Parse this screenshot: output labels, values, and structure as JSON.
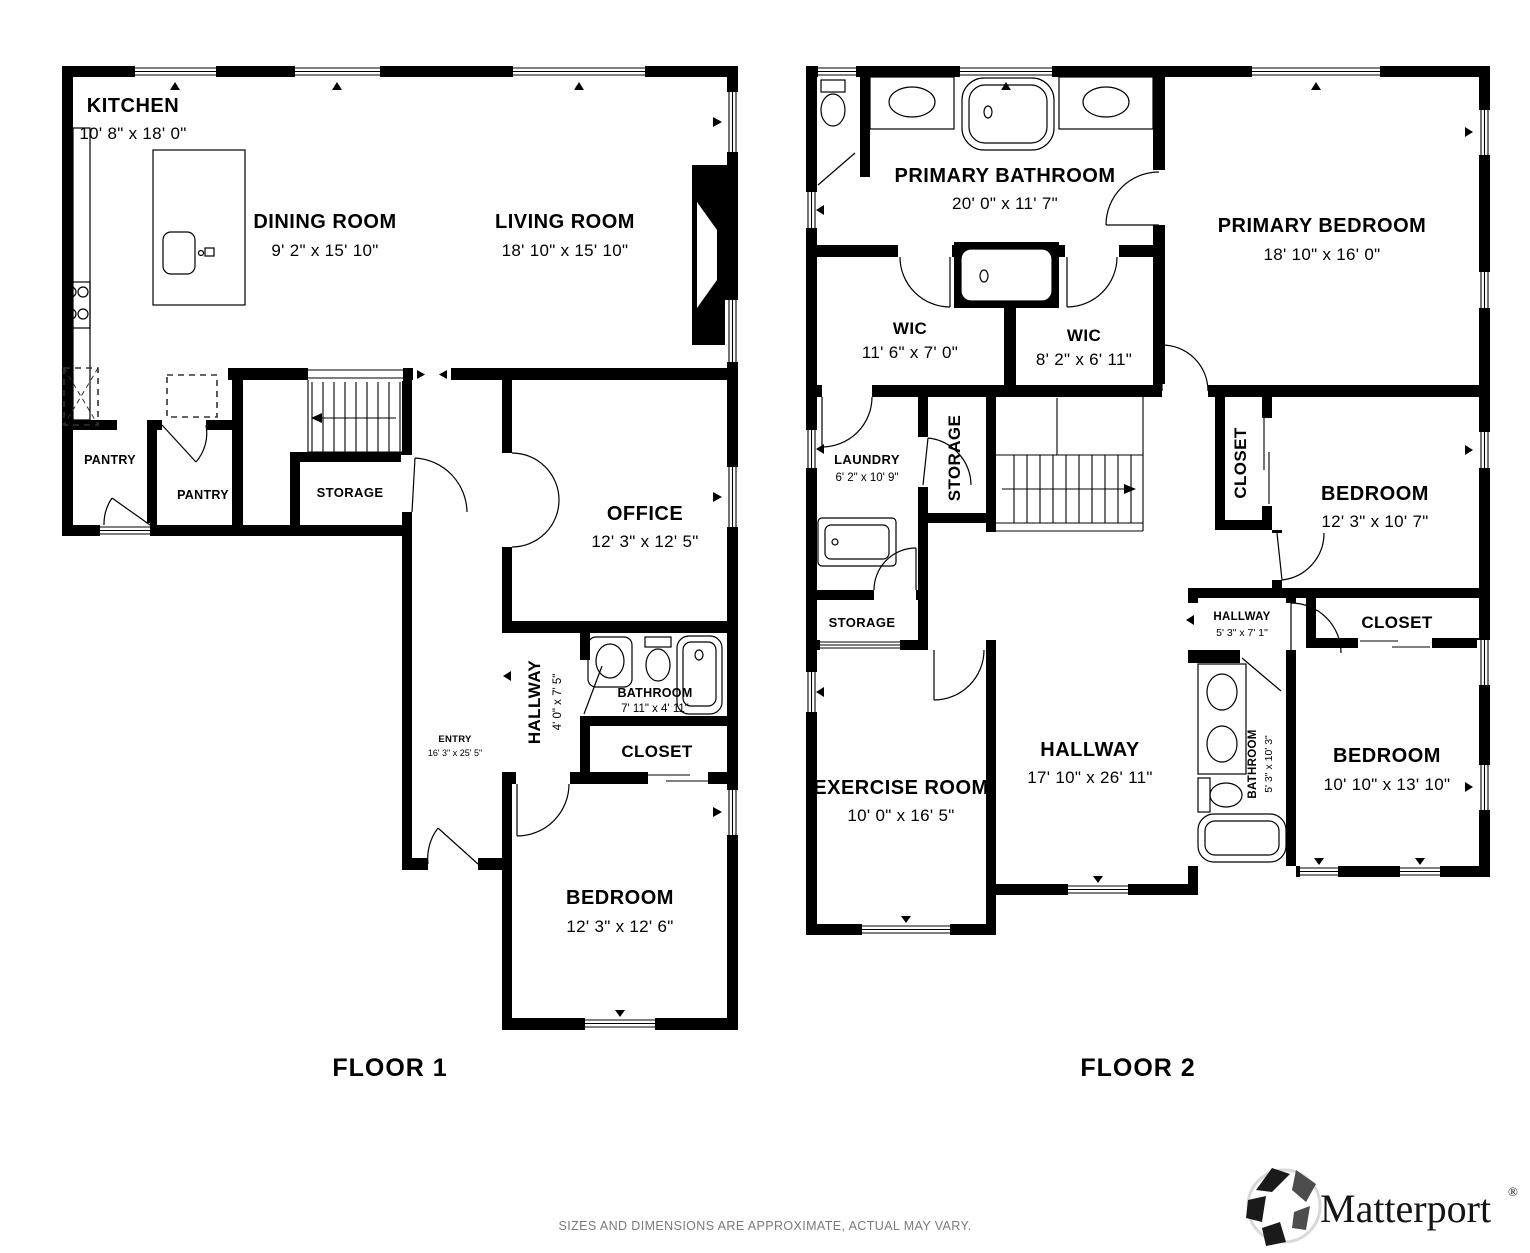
{
  "meta": {
    "colors": {
      "wall": "#000000",
      "label": "#000000",
      "muted_text": "#7a7a7a",
      "background": "#ffffff"
    }
  },
  "floor1": {
    "label": "FLOOR 1",
    "kitchen": {
      "name": "KITCHEN",
      "dims": "10' 8\" x 18' 0\""
    },
    "dining": {
      "name": "DINING ROOM",
      "dims": "9' 2\" x 15' 10\""
    },
    "living": {
      "name": "LIVING ROOM",
      "dims": "18' 10\" x 15' 10\""
    },
    "pantry1": {
      "name": "PANTRY"
    },
    "pantry2": {
      "name": "PANTRY"
    },
    "storage": {
      "name": "STORAGE"
    },
    "office": {
      "name": "OFFICE",
      "dims": "12' 3\" x 12' 5\""
    },
    "hallway": {
      "name": "HALLWAY",
      "dims": "4' 0\" x 7' 5\""
    },
    "bathroom": {
      "name": "BATHROOM",
      "dims": "7' 11\" x 4' 11\""
    },
    "closet": {
      "name": "CLOSET"
    },
    "entry": {
      "name": "ENTRY",
      "dims": "16' 3\" x 25' 5\""
    },
    "bedroom": {
      "name": "BEDROOM",
      "dims": "12' 3\" x 12' 6\""
    }
  },
  "floor2": {
    "label": "FLOOR 2",
    "primary_bathroom": {
      "name": "PRIMARY BATHROOM",
      "dims": "20' 0\" x 11' 7\""
    },
    "primary_bedroom": {
      "name": "PRIMARY BEDROOM",
      "dims": "18' 10\" x 16' 0\""
    },
    "wic1": {
      "name": "WIC",
      "dims": "11' 6\" x 7' 0\""
    },
    "wic2": {
      "name": "WIC",
      "dims": "8' 2\" x 6' 11\""
    },
    "laundry": {
      "name": "LAUNDRY",
      "dims": "6' 2\" x 10' 9\""
    },
    "storage1": {
      "name": "STORAGE"
    },
    "closet1": {
      "name": "CLOSET"
    },
    "bedroom1": {
      "name": "BEDROOM",
      "dims": "12' 3\" x 10' 7\""
    },
    "storage2": {
      "name": "STORAGE"
    },
    "hallway_small": {
      "name": "HALLWAY",
      "dims": "5' 3\" x 7' 1\""
    },
    "closet2": {
      "name": "CLOSET"
    },
    "exercise": {
      "name": "EXERCISE ROOM",
      "dims": "10' 0\" x 16' 5\""
    },
    "hallway": {
      "name": "HALLWAY",
      "dims": "17' 10\" x 26' 11\""
    },
    "bathroom": {
      "name": "BATHROOM",
      "dims": "5' 3\" x 10' 3\""
    },
    "bedroom2": {
      "name": "BEDROOM",
      "dims": "10' 10\" x 13' 10\""
    }
  },
  "footer": {
    "disclaimer": "SIZES AND DIMENSIONS ARE APPROXIMATE, ACTUAL MAY VARY."
  },
  "brand": {
    "name": "Matterport",
    "registered": "®"
  }
}
